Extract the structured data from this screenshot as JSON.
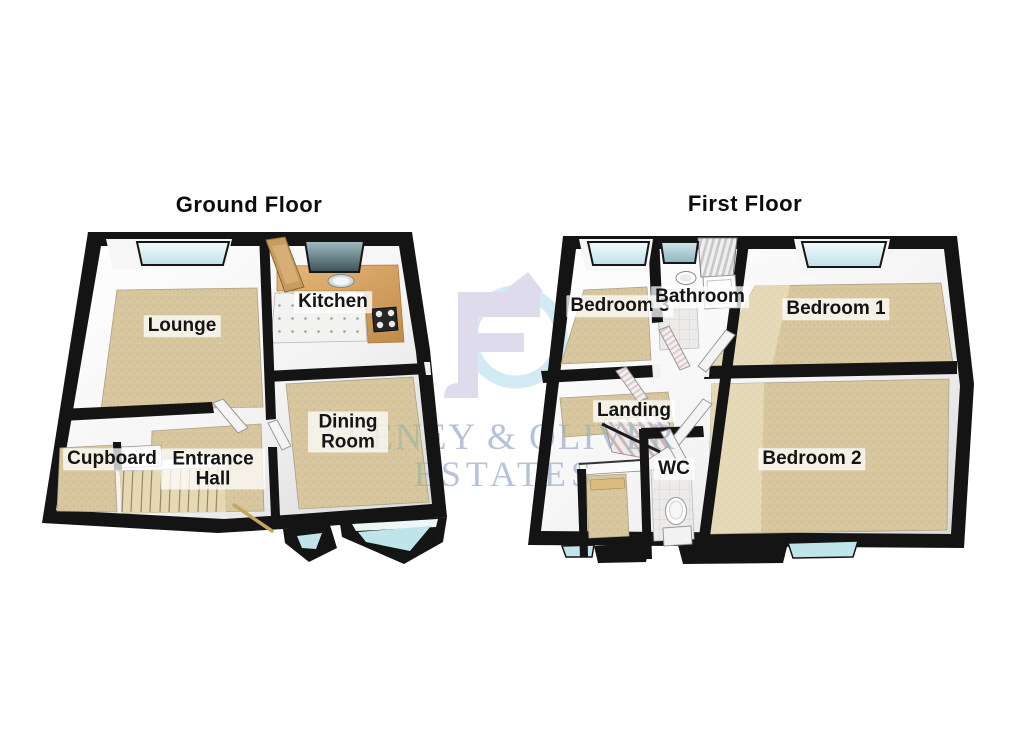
{
  "image": {
    "kind": "3d-floorplan",
    "background": "#ffffff"
  },
  "watermark": {
    "line1": "FEENEY & OLIVER",
    "line2": "ESTATES",
    "logo": "fo-monogram",
    "text_color": "#a9b9d2",
    "logo_lavender": "#dcdaeb",
    "logo_blue": "#cfe9f2"
  },
  "floors": [
    {
      "title": "Ground Floor",
      "rooms": [
        {
          "label": "Lounge"
        },
        {
          "label": "Kitchen"
        },
        {
          "label": "Cupboard"
        },
        {
          "label": "Entrance Hall"
        },
        {
          "label": "Dining Room"
        }
      ]
    },
    {
      "title": "First Floor",
      "rooms": [
        {
          "label": "Bedroom 3"
        },
        {
          "label": "Bathroom"
        },
        {
          "label": "Bedroom 1"
        },
        {
          "label": "Landing"
        },
        {
          "label": "WC"
        },
        {
          "label": "Bedroom 2"
        }
      ]
    }
  ],
  "colors": {
    "wall": "#141414",
    "floor_beige": "#d8c79e",
    "floor_beige_light": "#e5d9b8",
    "window_glass": "#cfe9ee",
    "kitchen_counter": "#d2a05e"
  }
}
